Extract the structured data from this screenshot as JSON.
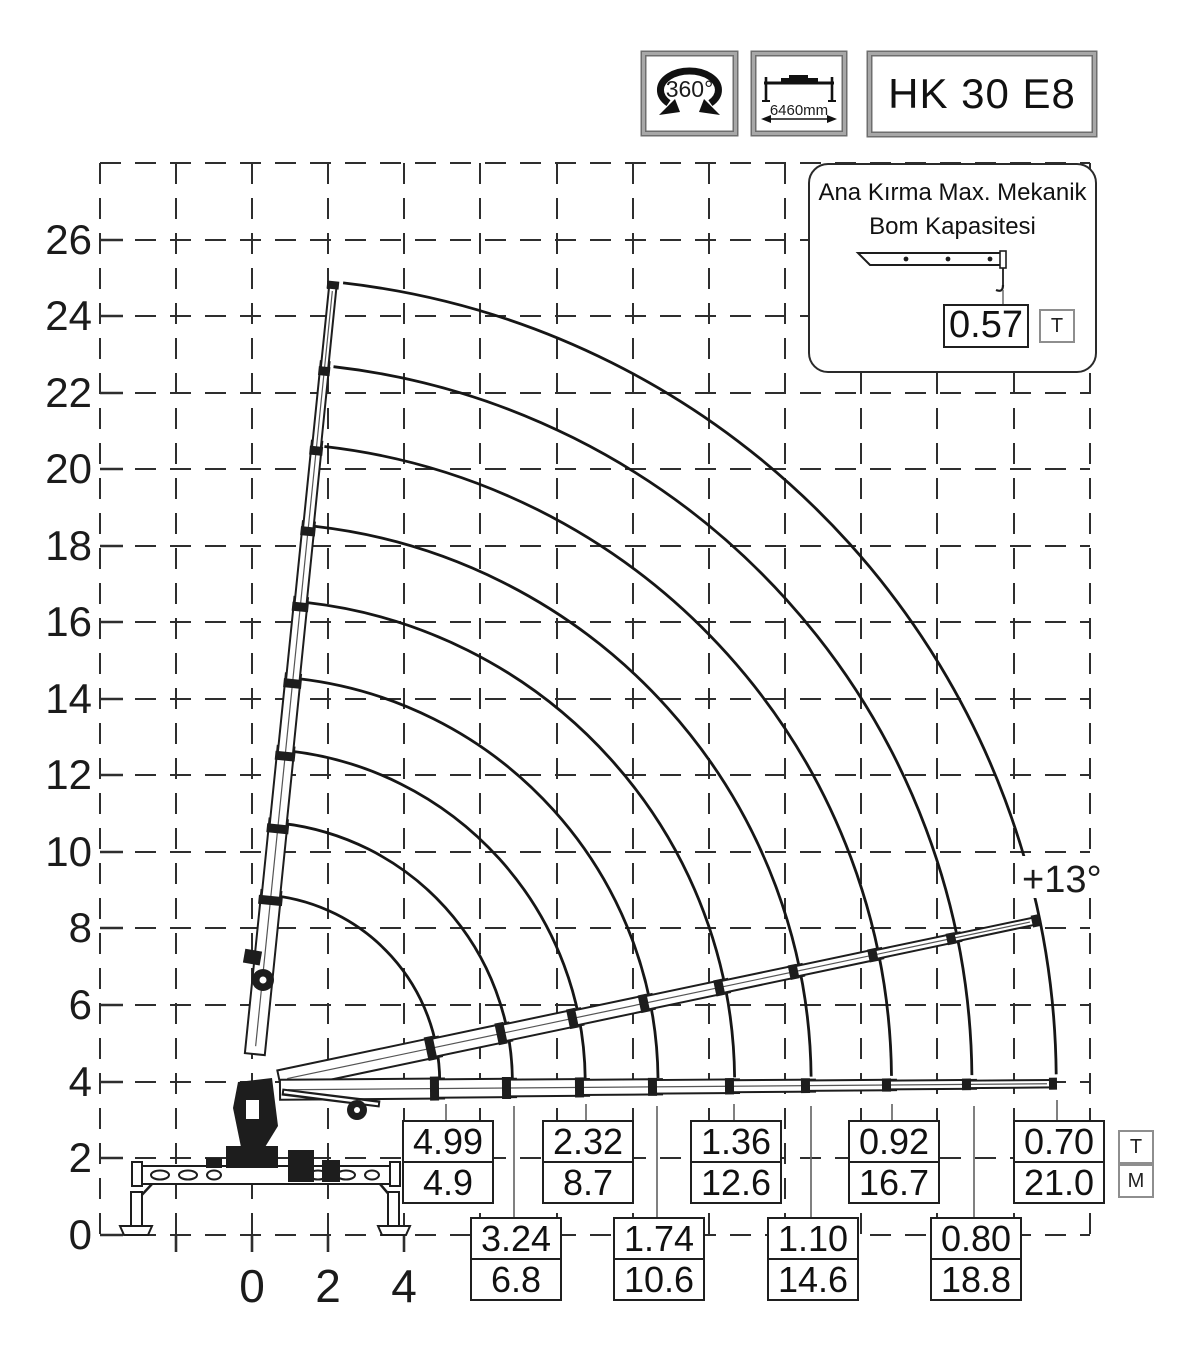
{
  "badges": {
    "rotation": "360°",
    "outrigger_span": "6460mm",
    "model": "HK 30 E8"
  },
  "callout": {
    "title_line1": "Ana Kırma Max. Mekanik",
    "title_line2": "Bom Kapasitesi",
    "value": "0.57",
    "unit": "T"
  },
  "axes": {
    "y": [
      "26",
      "24",
      "22",
      "20",
      "18",
      "16",
      "14",
      "12",
      "10",
      "8",
      "6",
      "4",
      "2",
      "0"
    ],
    "x": [
      "0",
      "2",
      "4"
    ]
  },
  "annotation": {
    "boom_angle": "+13°"
  },
  "unit_column": {
    "top": "T",
    "bottom": "M"
  },
  "load_boxes": {
    "row_top": [
      {
        "t": "4.99",
        "m": "4.9"
      },
      {
        "t": "2.32",
        "m": "8.7"
      },
      {
        "t": "1.36",
        "m": "12.6"
      },
      {
        "t": "0.92",
        "m": "16.7"
      },
      {
        "t": "0.70",
        "m": "21.0"
      }
    ],
    "row_bottom": [
      {
        "t": "3.24",
        "m": "6.8"
      },
      {
        "t": "1.74",
        "m": "10.6"
      },
      {
        "t": "1.10",
        "m": "14.6"
      },
      {
        "t": "0.80",
        "m": "18.8"
      }
    ]
  },
  "chart_data": {
    "type": "other",
    "subtype": "crane-working-range-load-diagram",
    "model": "HK 30 E8",
    "slewing_range": "360°",
    "outrigger_span_mm": 6460,
    "max_mechanical_boom_capacity": {
      "value": 0.57,
      "unit": "T"
    },
    "boom_angle_annotation_deg": 13,
    "y_axis": {
      "unit": "m",
      "min": 0,
      "max": 26,
      "step": 2
    },
    "x_axis": {
      "unit": "m",
      "ticks": [
        0,
        2,
        4
      ]
    },
    "units": {
      "capacity": "T",
      "outreach": "M"
    },
    "load_points": [
      {
        "capacity_t": 4.99,
        "outreach_m": 4.9
      },
      {
        "capacity_t": 3.24,
        "outreach_m": 6.8
      },
      {
        "capacity_t": 2.32,
        "outreach_m": 8.7
      },
      {
        "capacity_t": 1.74,
        "outreach_m": 10.6
      },
      {
        "capacity_t": 1.36,
        "outreach_m": 12.6
      },
      {
        "capacity_t": 1.1,
        "outreach_m": 14.6
      },
      {
        "capacity_t": 0.92,
        "outreach_m": 16.7
      },
      {
        "capacity_t": 0.8,
        "outreach_m": 18.8
      },
      {
        "capacity_t": 0.7,
        "outreach_m": 21.0
      }
    ]
  }
}
